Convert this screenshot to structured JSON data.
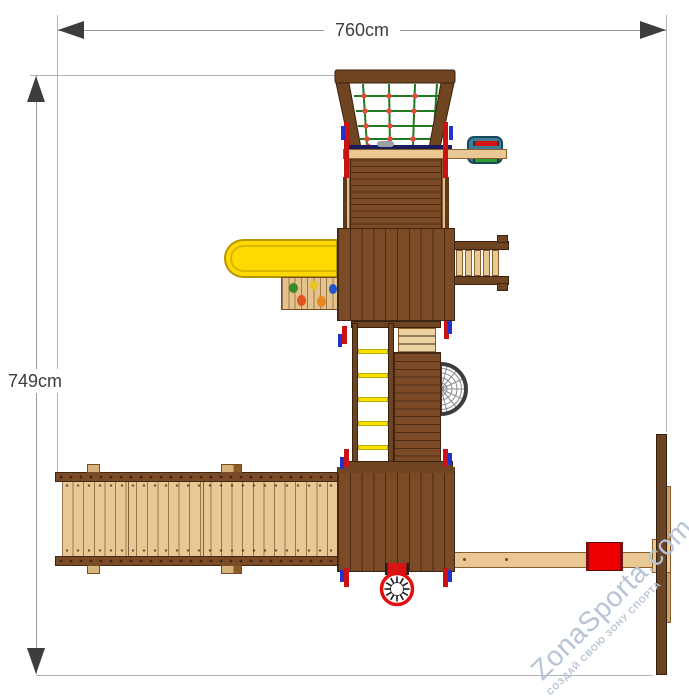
{
  "diagram": {
    "width_label": "760cm",
    "height_label": "749cm"
  },
  "watermark": {
    "brand": "ZonaSporta.com",
    "tagline": "СОЗДАЙ СВОЮ ЗОНУ СПОРТА"
  },
  "structure": {
    "monkey_bar_rungs": 5,
    "ladder_rungs": 5
  },
  "colors": {
    "dim": "#3d3d3d",
    "dim-line": "#9a9a9a",
    "line-gray": "#b4b4b4",
    "wood-dark": "#6f4420",
    "wood-mid": "#7b4a26",
    "wood-edge": "#3f2713",
    "wood-light": "#e9c893",
    "wood-light-edge": "#8a5f30",
    "wood-tan": "#d7b37c",
    "slide-yellow": "#ffd900",
    "slide-edge": "#b49600",
    "rung-yellow": "#f4e400",
    "accent-red": "#cc1111",
    "accent-blue": "#2233cc",
    "net-green": "#1f7a1f",
    "net-dot": "#e64a3c",
    "net-bar-navy": "#1a1a5e",
    "bucket-teal": "#3e7f93",
    "bucket-edge": "#174a5a",
    "seat-red": "#ee0000",
    "web-dark": "#3c3c3c",
    "web-light": "#8a8a8a",
    "wheel-red": "#e01010",
    "watermark": "#b7c3d6",
    "hold-green": "#3a8a28",
    "hold-yellow": "#e8c61e",
    "hold-blue": "#2255cc",
    "hold-red": "#e0541e",
    "hold-orange": "#e8891e"
  }
}
